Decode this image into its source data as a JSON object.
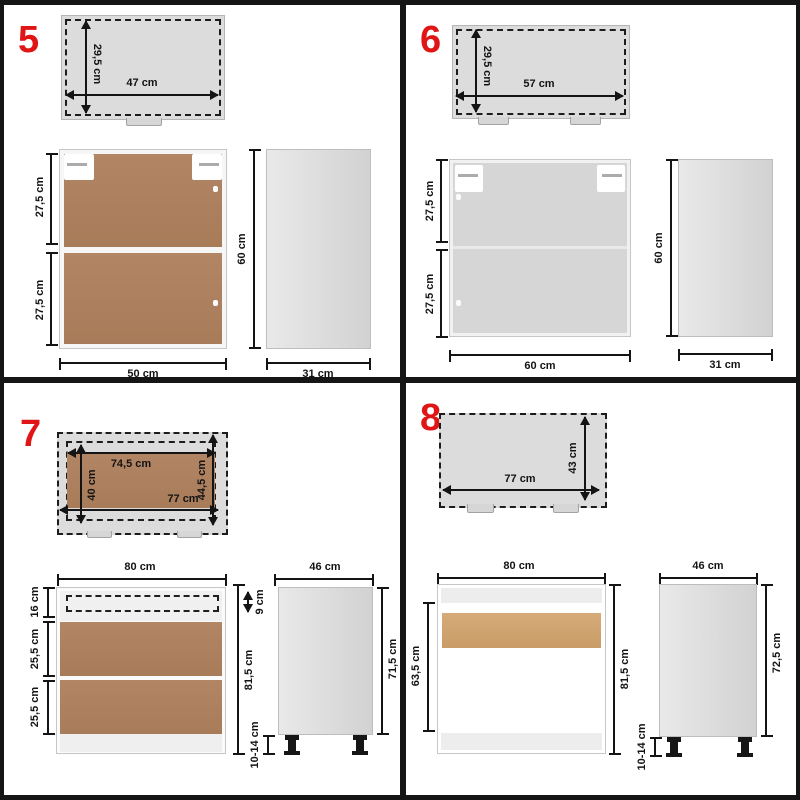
{
  "colors": {
    "accent_red": "#e01515",
    "wood_brown": "#ab8160",
    "light_wood": "#d0a471",
    "panel_gray": "#dcdcdc",
    "dimension_ink": "#141414"
  },
  "q5": {
    "num": "5",
    "top_h": "29,5 cm",
    "top_w": "47 cm",
    "front_s1": "27,5 cm",
    "front_s2": "27,5 cm",
    "front_w": "50 cm",
    "side_h": "60 cm",
    "side_d": "31 cm"
  },
  "q6": {
    "num": "6",
    "top_h": "29,5 cm",
    "top_w": "57 cm",
    "front_s1": "27,5 cm",
    "front_s2": "27,5 cm",
    "front_w": "60 cm",
    "side_h": "60 cm",
    "side_d": "31 cm"
  },
  "q7": {
    "num": "7",
    "top_inner_w": "74,5 cm",
    "top_left_h": "40 cm",
    "top_right_h": "44,5 cm",
    "top_w": "77 cm",
    "front_w": "80 cm",
    "front_s1": "16 cm",
    "front_s2": "25,5 cm",
    "front_s3": "25,5 cm",
    "drawer_h": "9 cm",
    "front_h": "81,5 cm",
    "side_d": "46 cm",
    "side_h": "71,5 cm",
    "leg_h": "10-14 cm"
  },
  "q8": {
    "num": "8",
    "top_h": "43 cm",
    "top_w": "77 cm",
    "front_w": "80 cm",
    "front_left_h": "63,5 cm",
    "front_h": "81,5 cm",
    "side_d": "46 cm",
    "side_h": "72,5 cm",
    "leg_h": "10-14 cm"
  }
}
